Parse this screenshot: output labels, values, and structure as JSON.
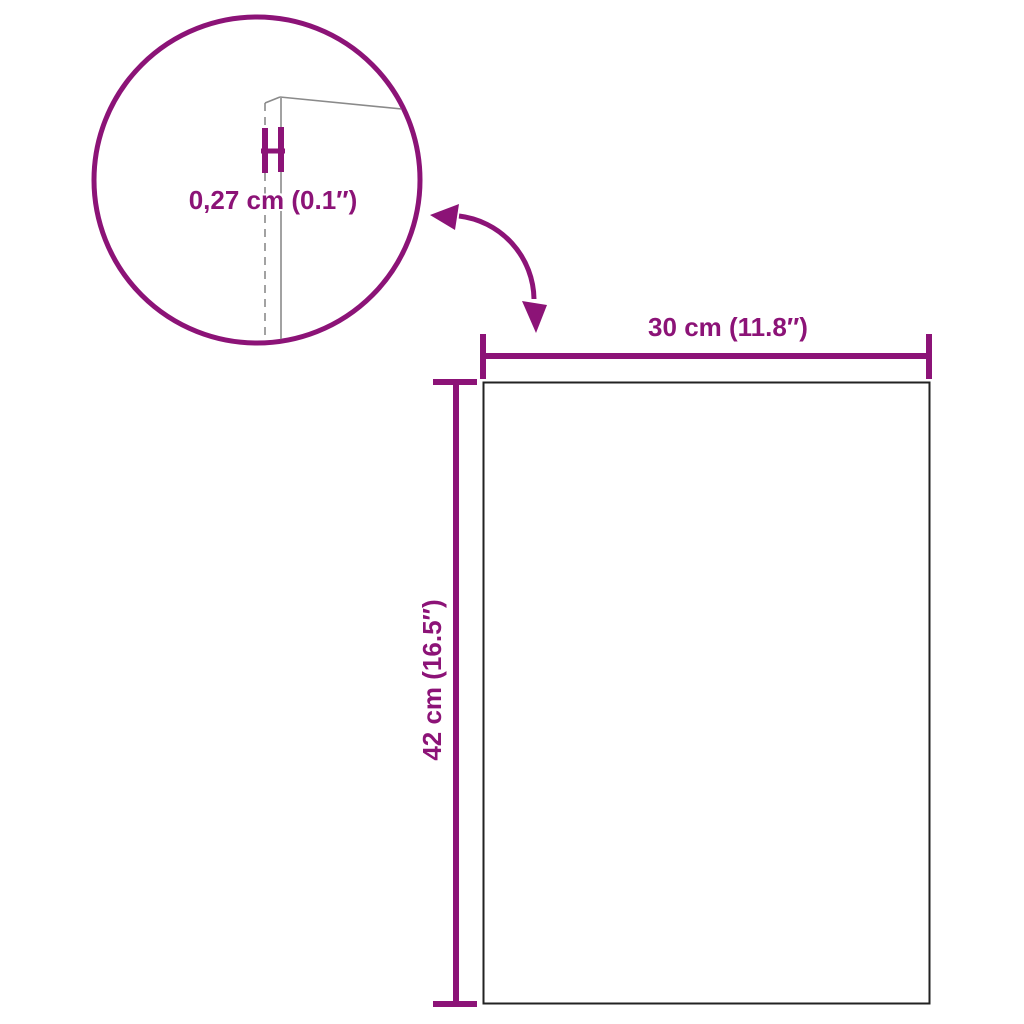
{
  "colors": {
    "accent_purple": "#8C1377",
    "panel_edge_gray": "#8a8a8a",
    "rect_border": "#222222",
    "background": "#ffffff"
  },
  "diagram": {
    "kind": "product-dimension-diagram",
    "shape": "rectangular-panel",
    "dimensions": {
      "width": {
        "label": "30 cm (11.8″)",
        "cm": 30,
        "inches": 11.8
      },
      "height": {
        "label": "42 cm (16.5″)",
        "cm": 42,
        "inches": 16.5
      },
      "thickness": {
        "label": "0,27 cm (0.1″)",
        "cm": 0.27,
        "inches": 0.1
      }
    },
    "annotations": {
      "magnifier_circle": "zoom detail of panel edge thickness",
      "zoom_arrow": "curved arrow linking detail circle to panel"
    }
  }
}
